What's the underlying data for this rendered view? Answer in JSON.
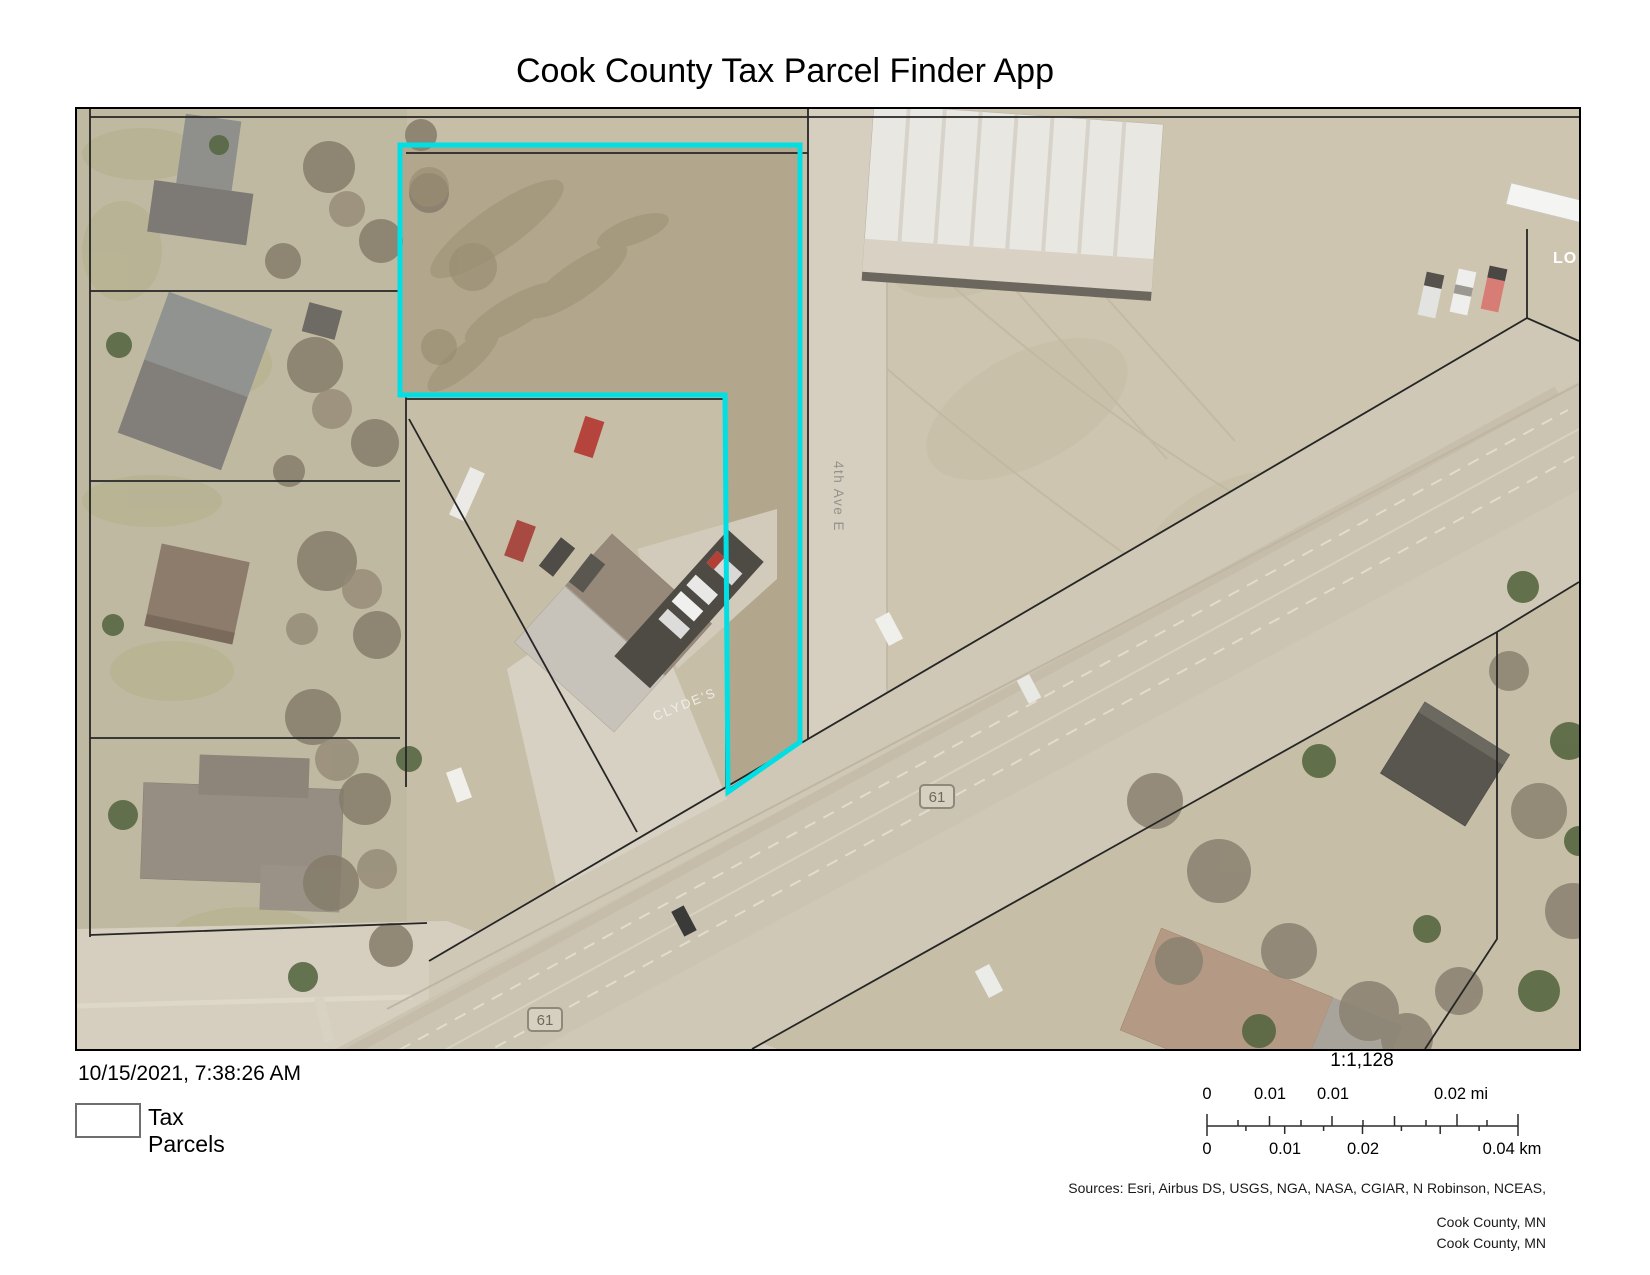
{
  "title": "Cook County Tax Parcel Finder App",
  "map": {
    "street_label": "4th Ave E",
    "highway_shield": "61",
    "edge_label": "LO",
    "painted_text": "CLYDE'S",
    "highlight_color": "#00dfe4",
    "parcel_line_color": "#262626"
  },
  "footer": {
    "timestamp": "10/15/2021, 7:38:26 AM",
    "legend_label": "Tax Parcels"
  },
  "scale": {
    "ratio": "1:1,128",
    "mi_labels": [
      "0",
      "0.01",
      "0.01",
      "0.02 mi"
    ],
    "km_labels": [
      "0",
      "0.01",
      "0.02",
      "0.04 km"
    ]
  },
  "attribution": {
    "sources": "Sources: Esri, Airbus DS, USGS, NGA, NASA, CGIAR, N Robinson, NCEAS,",
    "credit_line1": "Cook County, MN",
    "credit_line2": "Cook County, MN"
  }
}
